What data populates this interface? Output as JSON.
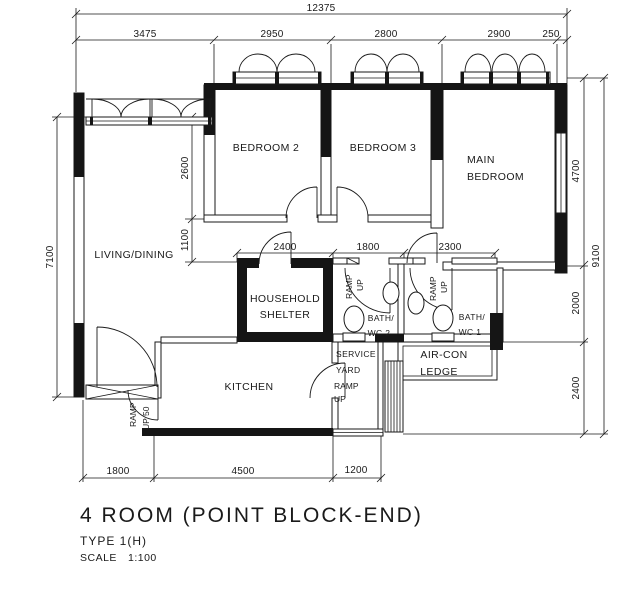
{
  "title": {
    "main": "4 ROOM (POINT BLOCK-END)",
    "type": "TYPE 1(H)",
    "scale_label": "SCALE",
    "scale_value": "1:100"
  },
  "rooms": {
    "living": "LIVING/DINING",
    "bedroom2": "BEDROOM 2",
    "bedroom3": "BEDROOM 3",
    "main_line1": "MAIN",
    "main_line2": "BEDROOM",
    "shelter_line1": "HOUSEHOLD",
    "shelter_line2": "SHELTER",
    "bath2_line1": "BATH/",
    "bath2_line2": "WC 2",
    "bath1_line1": "BATH/",
    "bath1_line2": "WC 1",
    "aircon_line1": "AIR-CON",
    "aircon_line2": "LEDGE",
    "service_line1": "SERVICE",
    "service_line2": "YARD",
    "kitchen": "KITCHEN"
  },
  "ramps": {
    "entrance_line1": "RAMP",
    "entrance_line2": "UP 50",
    "bath2_line1": "RAMP",
    "bath2_line2": "UP",
    "bath1_line1": "RAMP",
    "bath1_line2": "UP",
    "service_line1": "RAMP",
    "service_line2": "UP"
  },
  "dims": {
    "top_total": "12375",
    "top": [
      "3475",
      "2950",
      "2800",
      "2900",
      "250"
    ],
    "left_total": "7100",
    "interior_v": [
      "2600",
      "1100"
    ],
    "mid": [
      "2400",
      "1800",
      "2300"
    ],
    "right": [
      "4700",
      "2000",
      "2400"
    ],
    "right_total": "9100",
    "bottom": [
      "1800",
      "4500",
      "1200"
    ]
  },
  "colors": {
    "ink": "#1a1a1a",
    "background": "#ffffff"
  }
}
